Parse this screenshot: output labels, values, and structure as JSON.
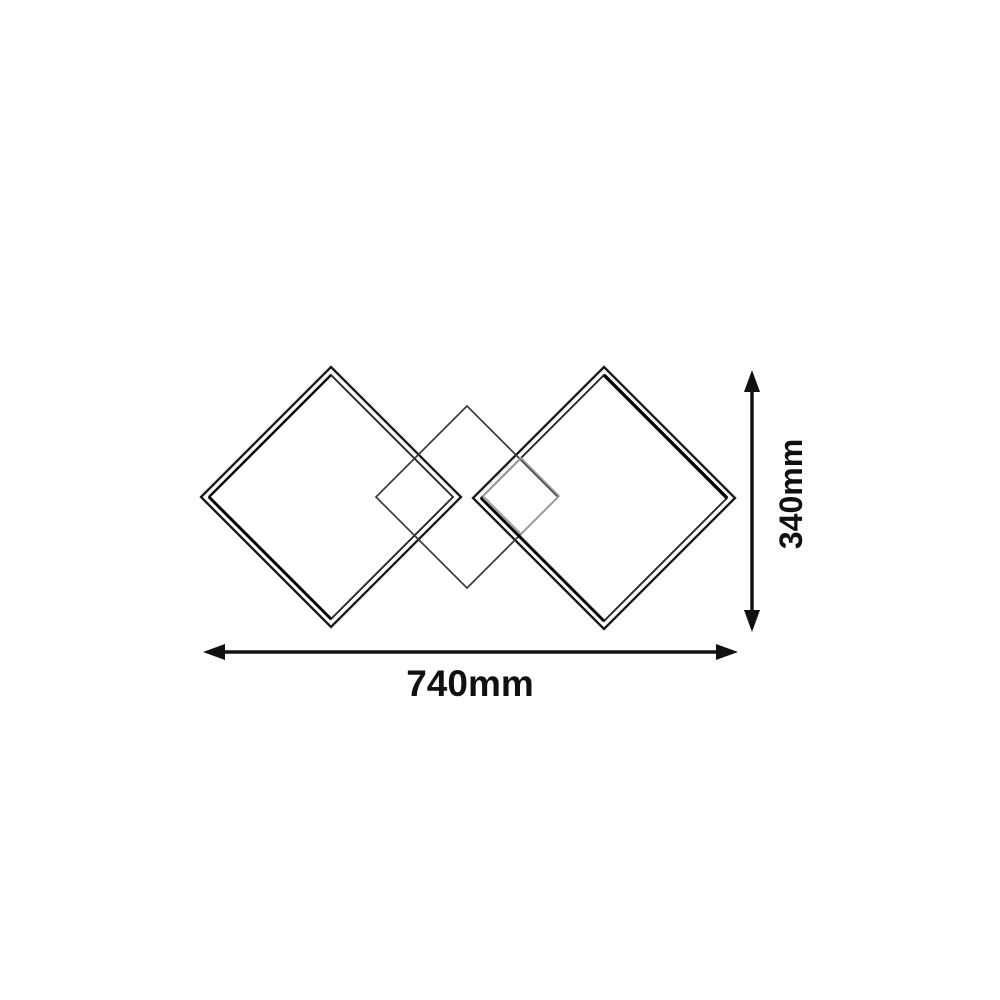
{
  "meta": {
    "type": "product-dimension-drawing",
    "description": "Line drawing of a ceiling light made of two large square LED frames rotated 45 degrees with a medium and a small diamond plate overlapping in the centre, annotated with width and height dimensions",
    "background": "#ffffff"
  },
  "labels": {
    "width": "740mm",
    "height": "340mm"
  },
  "colors": {
    "frame_outer": "#161616",
    "frame_inner": "#2a2a2a",
    "frame_shade": "#050505",
    "center_diamond": "#3d3d3d",
    "small_diamond": "#9c9c9c",
    "dimension": "#101010"
  },
  "drawing": {
    "diamonds": [
      {
        "name": "left-frame-outer",
        "cx": 331,
        "cy": 497,
        "r": 130,
        "color_key": "frame_outer",
        "width": 2.3
      },
      {
        "name": "left-frame-inner",
        "cx": 331,
        "cy": 497,
        "r": 122,
        "color_key": "frame_inner",
        "width": 1.9
      },
      {
        "name": "right-frame-outer",
        "cx": 604,
        "cy": 498,
        "r": 131,
        "color_key": "frame_outer",
        "width": 2.3
      },
      {
        "name": "right-frame-inner",
        "cx": 604,
        "cy": 498,
        "r": 123,
        "color_key": "frame_inner",
        "width": 1.9
      },
      {
        "name": "center-diamond",
        "cx": 467,
        "cy": 497,
        "r": 91,
        "color_key": "center_diamond",
        "width": 1.7
      },
      {
        "name": "small-diamond",
        "cx": 521,
        "cy": 496,
        "r": 38,
        "color_key": "small_diamond",
        "width": 1.7
      }
    ],
    "shade_edges": [
      {
        "name": "left-frame-shade-upper-left",
        "x1": 331,
        "y1": 375,
        "x2": 209,
        "y2": 497,
        "width": 2.4
      },
      {
        "name": "left-frame-shade-lower-left",
        "x1": 209,
        "y1": 497,
        "x2": 331,
        "y2": 619,
        "width": 3.0
      },
      {
        "name": "right-frame-shade-upper-right",
        "x1": 604,
        "y1": 375,
        "x2": 727,
        "y2": 498,
        "width": 3.4
      },
      {
        "name": "right-frame-shade-lower-left",
        "x1": 481,
        "y1": 498,
        "x2": 604,
        "y2": 621,
        "width": 3.0
      }
    ],
    "h_dim": {
      "y": 652,
      "x1": 203,
      "x2": 738,
      "line_width": 3.4,
      "arrow_len": 22,
      "arrow_halfwidth": 8,
      "label_x": 470,
      "label_y": 696,
      "font_size": 37
    },
    "v_dim": {
      "x": 752,
      "y1": 370,
      "y2": 632,
      "line_width": 3.4,
      "arrow_len": 22,
      "arrow_halfwidth": 8,
      "label_x": 802,
      "label_y": 494,
      "font_size": 32
    }
  }
}
